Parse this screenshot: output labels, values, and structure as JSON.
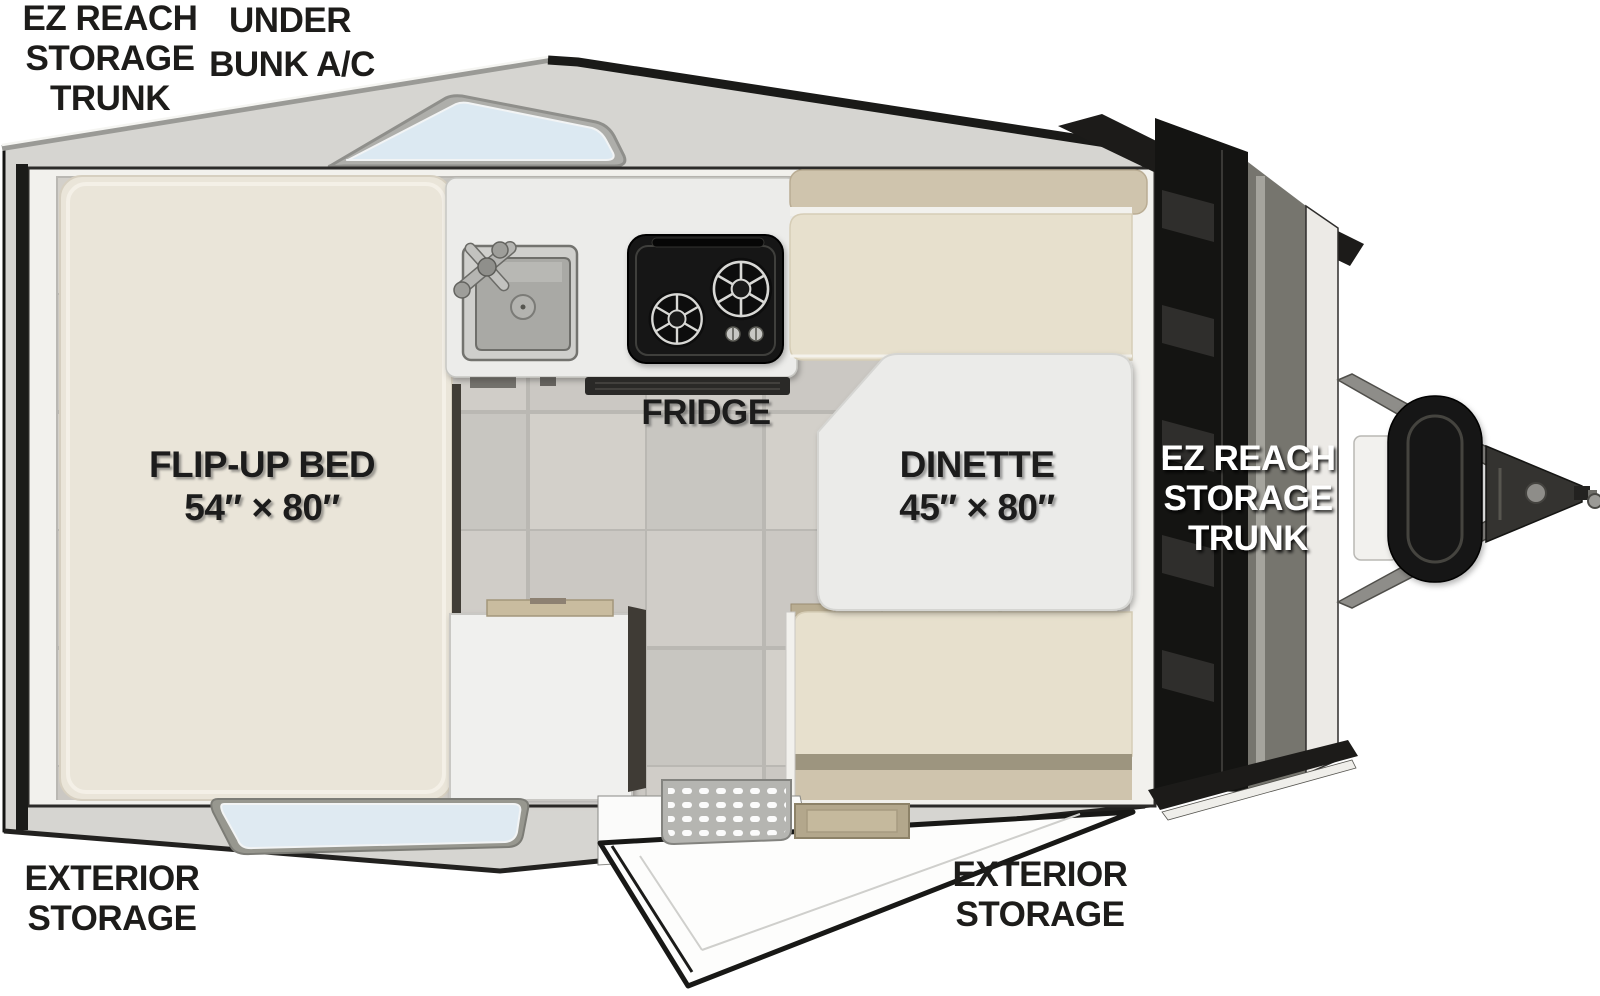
{
  "page": {
    "background": "#ffffff",
    "type": "rv-floorplan"
  },
  "labels": {
    "rear_trunk": {
      "lines": [
        "EZ REACH",
        "STORAGE",
        "TRUNK"
      ]
    },
    "under_bunk_ac": {
      "lines": [
        "UNDER",
        "BUNK A/C"
      ]
    },
    "flip_up_bed": {
      "lines": [
        "FLIP-UP BED",
        "54″ × 80″"
      ]
    },
    "fridge": {
      "text": "FRIDGE"
    },
    "dinette": {
      "lines": [
        "DINETTE",
        "45″ × 80″"
      ]
    },
    "front_trunk": {
      "lines": [
        "EZ REACH",
        "STORAGE",
        "TRUNK"
      ]
    },
    "exterior_storage_rear": {
      "lines": [
        "EXTERIOR",
        "STORAGE"
      ]
    },
    "exterior_storage_entry": {
      "lines": [
        "EXTERIOR",
        "STORAGE"
      ]
    }
  },
  "colors": {
    "shell_gray": "#d6d5d1",
    "roof_edge_dark": "#161614",
    "wall_white": "#f2f1ed",
    "floor_tile": "#cdcac5",
    "bed_cream": "#eae5d9",
    "cushion_seat": "#e7e0cd",
    "cushion_back": "#cfc4ad",
    "cushion_seam": "#9d957f",
    "counter_white": "#ececea",
    "stove_black": "#161616",
    "table_white": "#ebebe9",
    "glass_blue": "#dce9f2",
    "trunk_black": "#141412",
    "metal_gray": "#8e8d89",
    "wood_tan": "#c9bc9f",
    "label_dark": "#1d1c1a",
    "label_white": "#ffffff"
  }
}
